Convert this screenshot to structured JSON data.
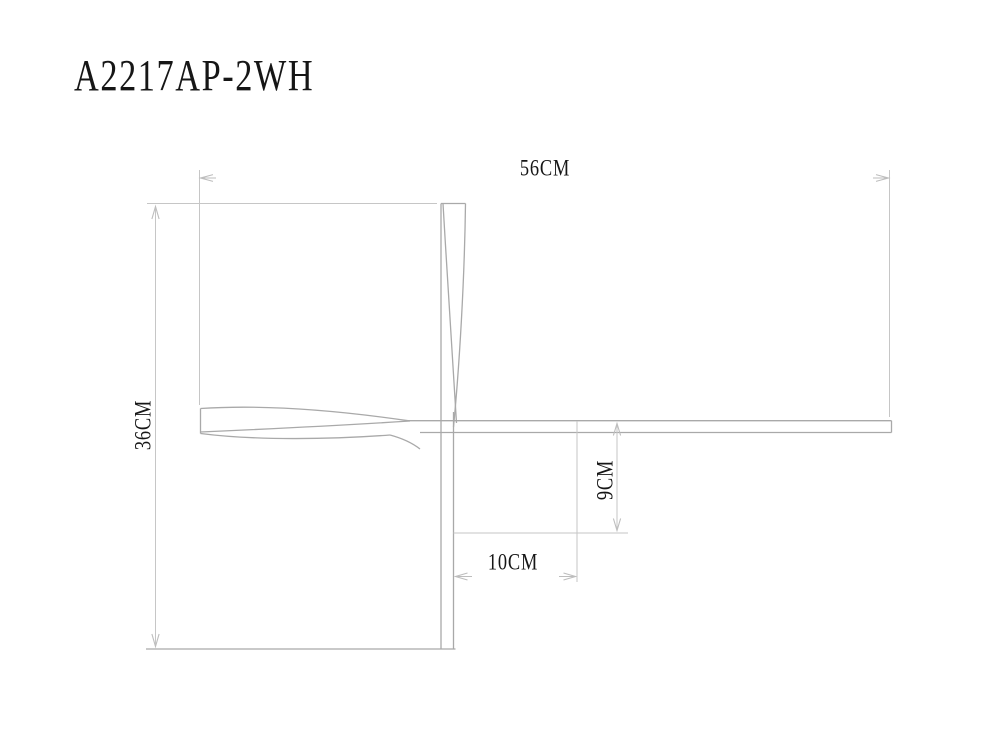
{
  "title": "A2217AP-2WH",
  "dimensions": {
    "overall_width": "56CM",
    "overall_height": "36CM",
    "arm_drop": "9CM",
    "head_offset": "10CM"
  },
  "colors": {
    "background": "#ffffff",
    "drawing_line": "#a9a9a9",
    "dimension_line": "#c6c6c6",
    "text": "#161616"
  }
}
